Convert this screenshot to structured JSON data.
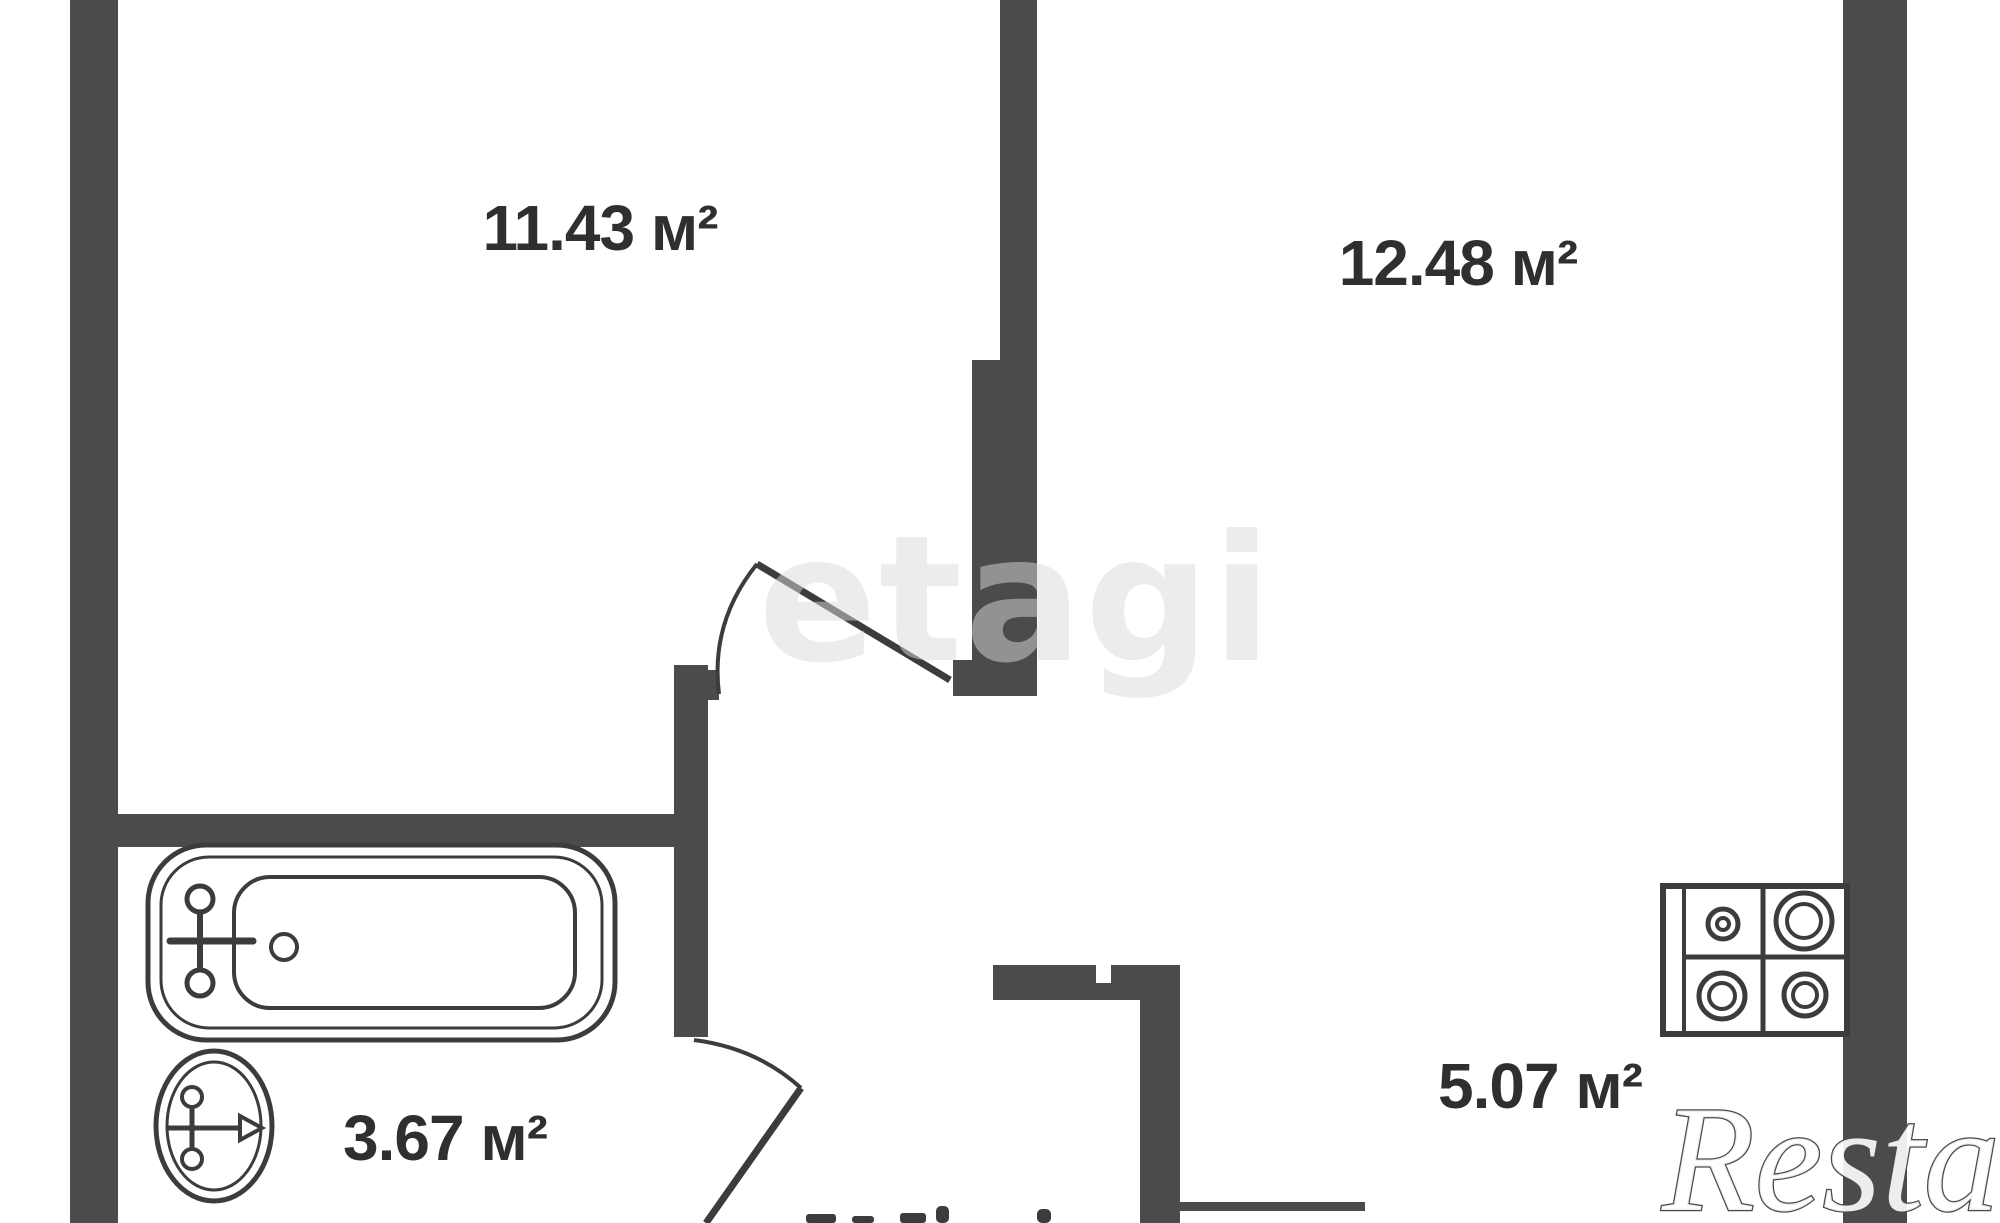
{
  "plan_type": "apartment-floor-plan",
  "rooms": [
    {
      "name": "room-top-left",
      "area_label": "11.43 м²"
    },
    {
      "name": "room-top-right",
      "area_label": "12.48 м²"
    },
    {
      "name": "bathroom",
      "area_label": "3.67 м²"
    },
    {
      "name": "kitchen",
      "area_label": "5.07 м²"
    }
  ],
  "watermarks": {
    "center": "etagi",
    "bottom_right": "Restate"
  },
  "fixtures": [
    "bathtub-icon",
    "sink-icon",
    "stove-4-burner-icon"
  ],
  "colors": {
    "wall": "#4b4b4a",
    "fixture_line": "#3c3c3c",
    "label_text": "#2f2f2f",
    "watermark": "#d9d9d9",
    "background": "#ffffff"
  },
  "notes": {
    "bottom_edge_label_cut": true
  }
}
